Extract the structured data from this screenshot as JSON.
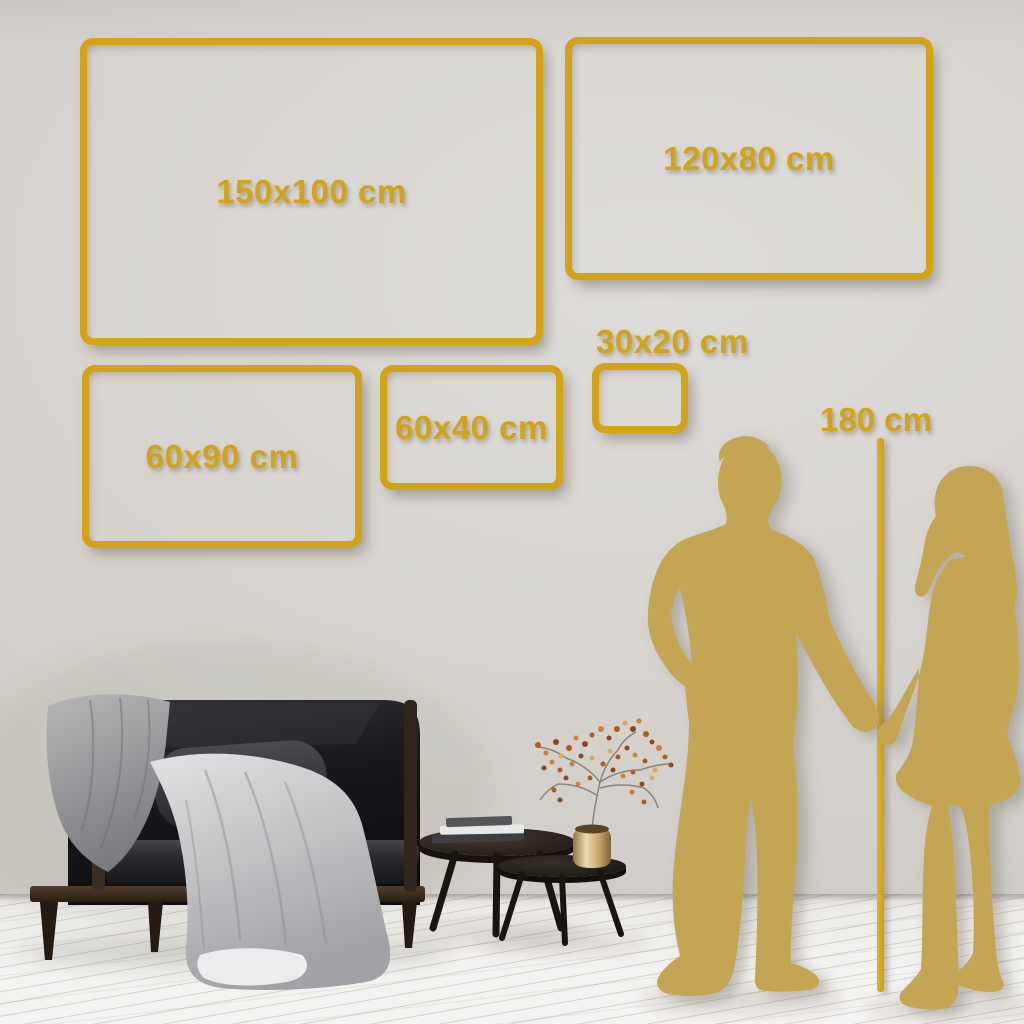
{
  "title": "Wall art size guide",
  "palette": {
    "gold": "#d2a217",
    "silhouette_gold": "#c3a552",
    "wall": "#d5d2ce",
    "floor": "#f1f0ee",
    "sofa_dark": "#141417",
    "wood_brown": "#3c2f24",
    "pillow_beige": "#d8b689",
    "blanket_gray": "#b9b9bc",
    "vase_brass": "#cfae74"
  },
  "size_frames": [
    {
      "label": "150x100 cm",
      "x": 80,
      "y": 38,
      "w": 463,
      "h": 307,
      "label_placement": "inside"
    },
    {
      "label": "120x80 cm",
      "x": 565,
      "y": 37,
      "w": 368,
      "h": 243,
      "label_placement": "inside"
    },
    {
      "label": "60x90 cm",
      "x": 82,
      "y": 365,
      "w": 280,
      "h": 183,
      "label_placement": "inside"
    },
    {
      "label": "60x40 cm",
      "x": 380,
      "y": 365,
      "w": 183,
      "h": 125,
      "label_placement": "inside"
    },
    {
      "label": "30x20 cm",
      "x": 592,
      "y": 363,
      "w": 96,
      "h": 70,
      "label_placement": "above"
    }
  ],
  "height_reference": {
    "label": "180 cm"
  },
  "scene": {
    "items": [
      "dark-sofa",
      "gray-throw-blankets",
      "beige-pillow",
      "dark-pillow",
      "nesting-coffee-tables",
      "books-stack",
      "brass-vase-with-dried-branch",
      "man-silhouette",
      "woman-silhouette",
      "plank-floor"
    ]
  }
}
